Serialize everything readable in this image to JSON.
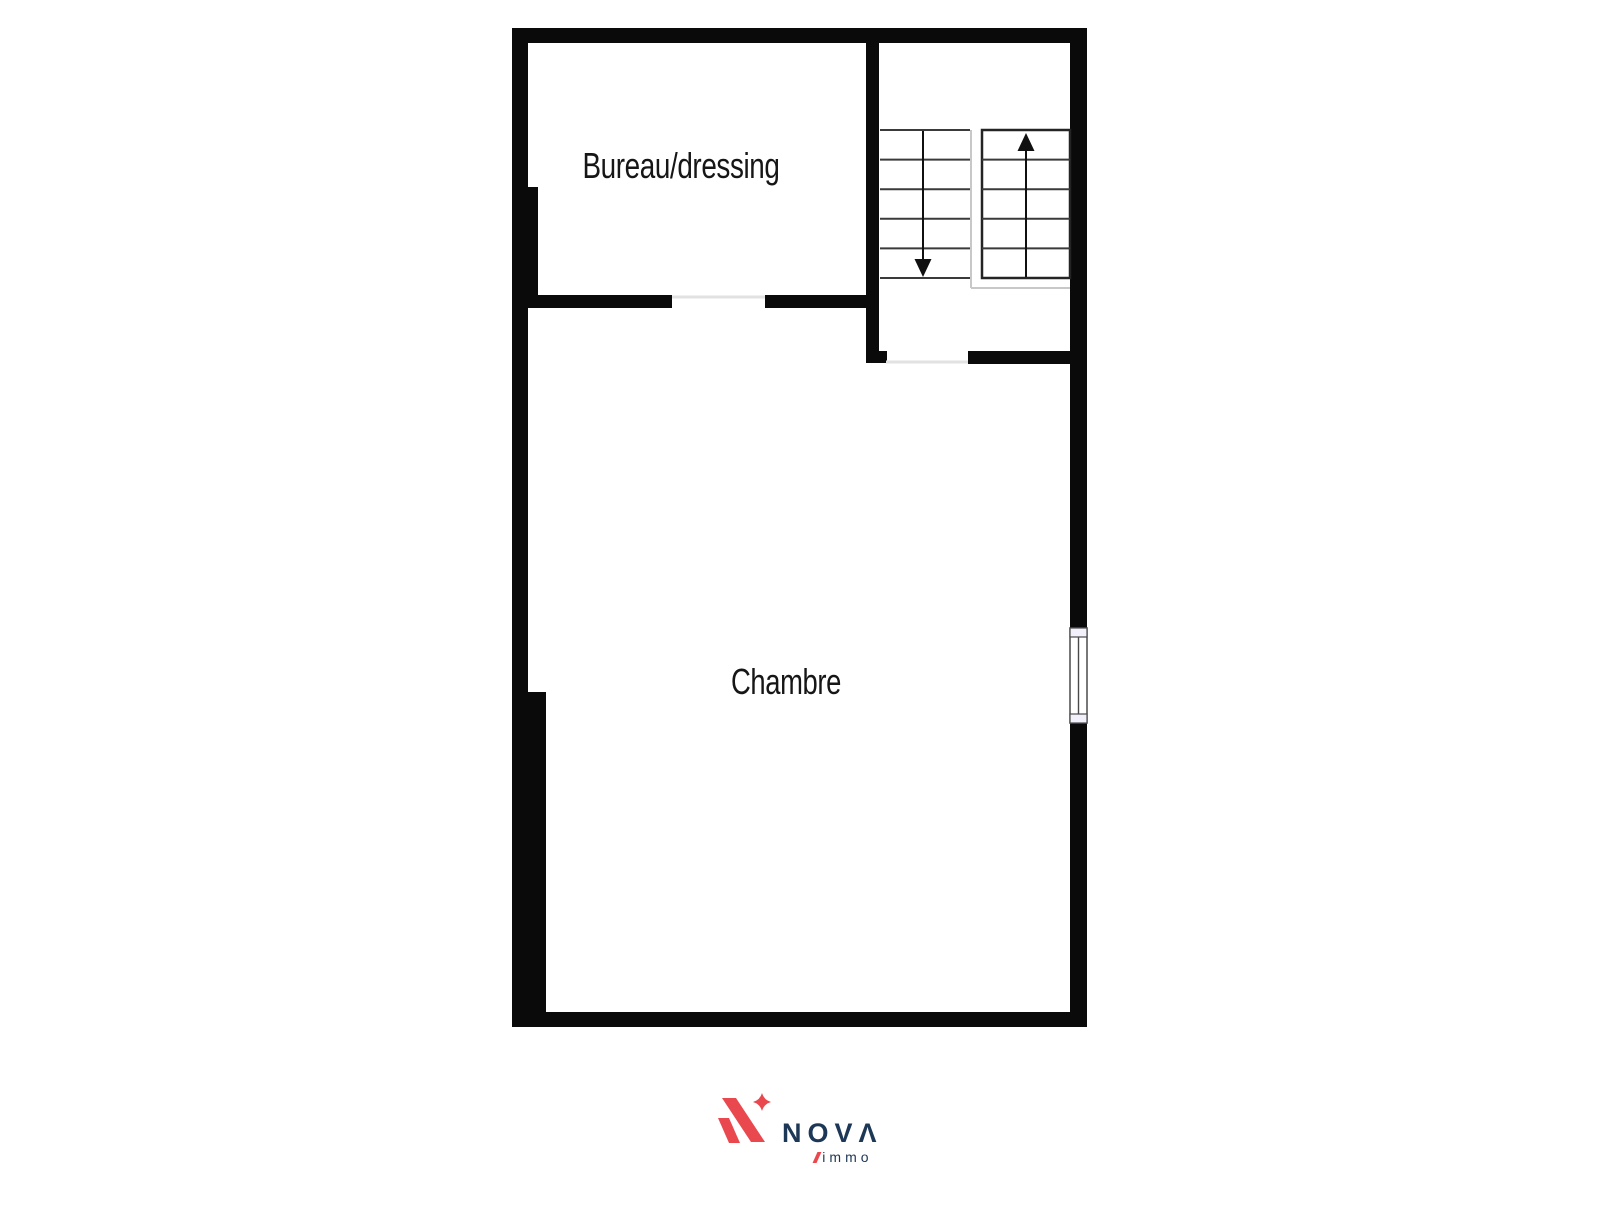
{
  "page": {
    "background": "#ffffff"
  },
  "plan": {
    "labels": {
      "bureau": "Bureau/dressing",
      "chambre": "Chambre"
    },
    "stairs": {
      "left_flight_steps": 5,
      "right_flight_steps": 5,
      "left_arrow_direction": "down",
      "right_arrow_direction": "up"
    },
    "colors": {
      "wall": "#0a0a0a",
      "step": "#3a3a3a",
      "flight_border": "#242424",
      "landing": "#c8c8c8",
      "threshold": "#e2e2e2",
      "window_frame": "#4a4a4a",
      "window_fill": "#f2f0fa",
      "label": "#161616"
    }
  },
  "logo": {
    "brand": "NOVΛ",
    "sub": "immo",
    "colors": {
      "red": "#e9494e",
      "navy": "#1d3756"
    }
  }
}
